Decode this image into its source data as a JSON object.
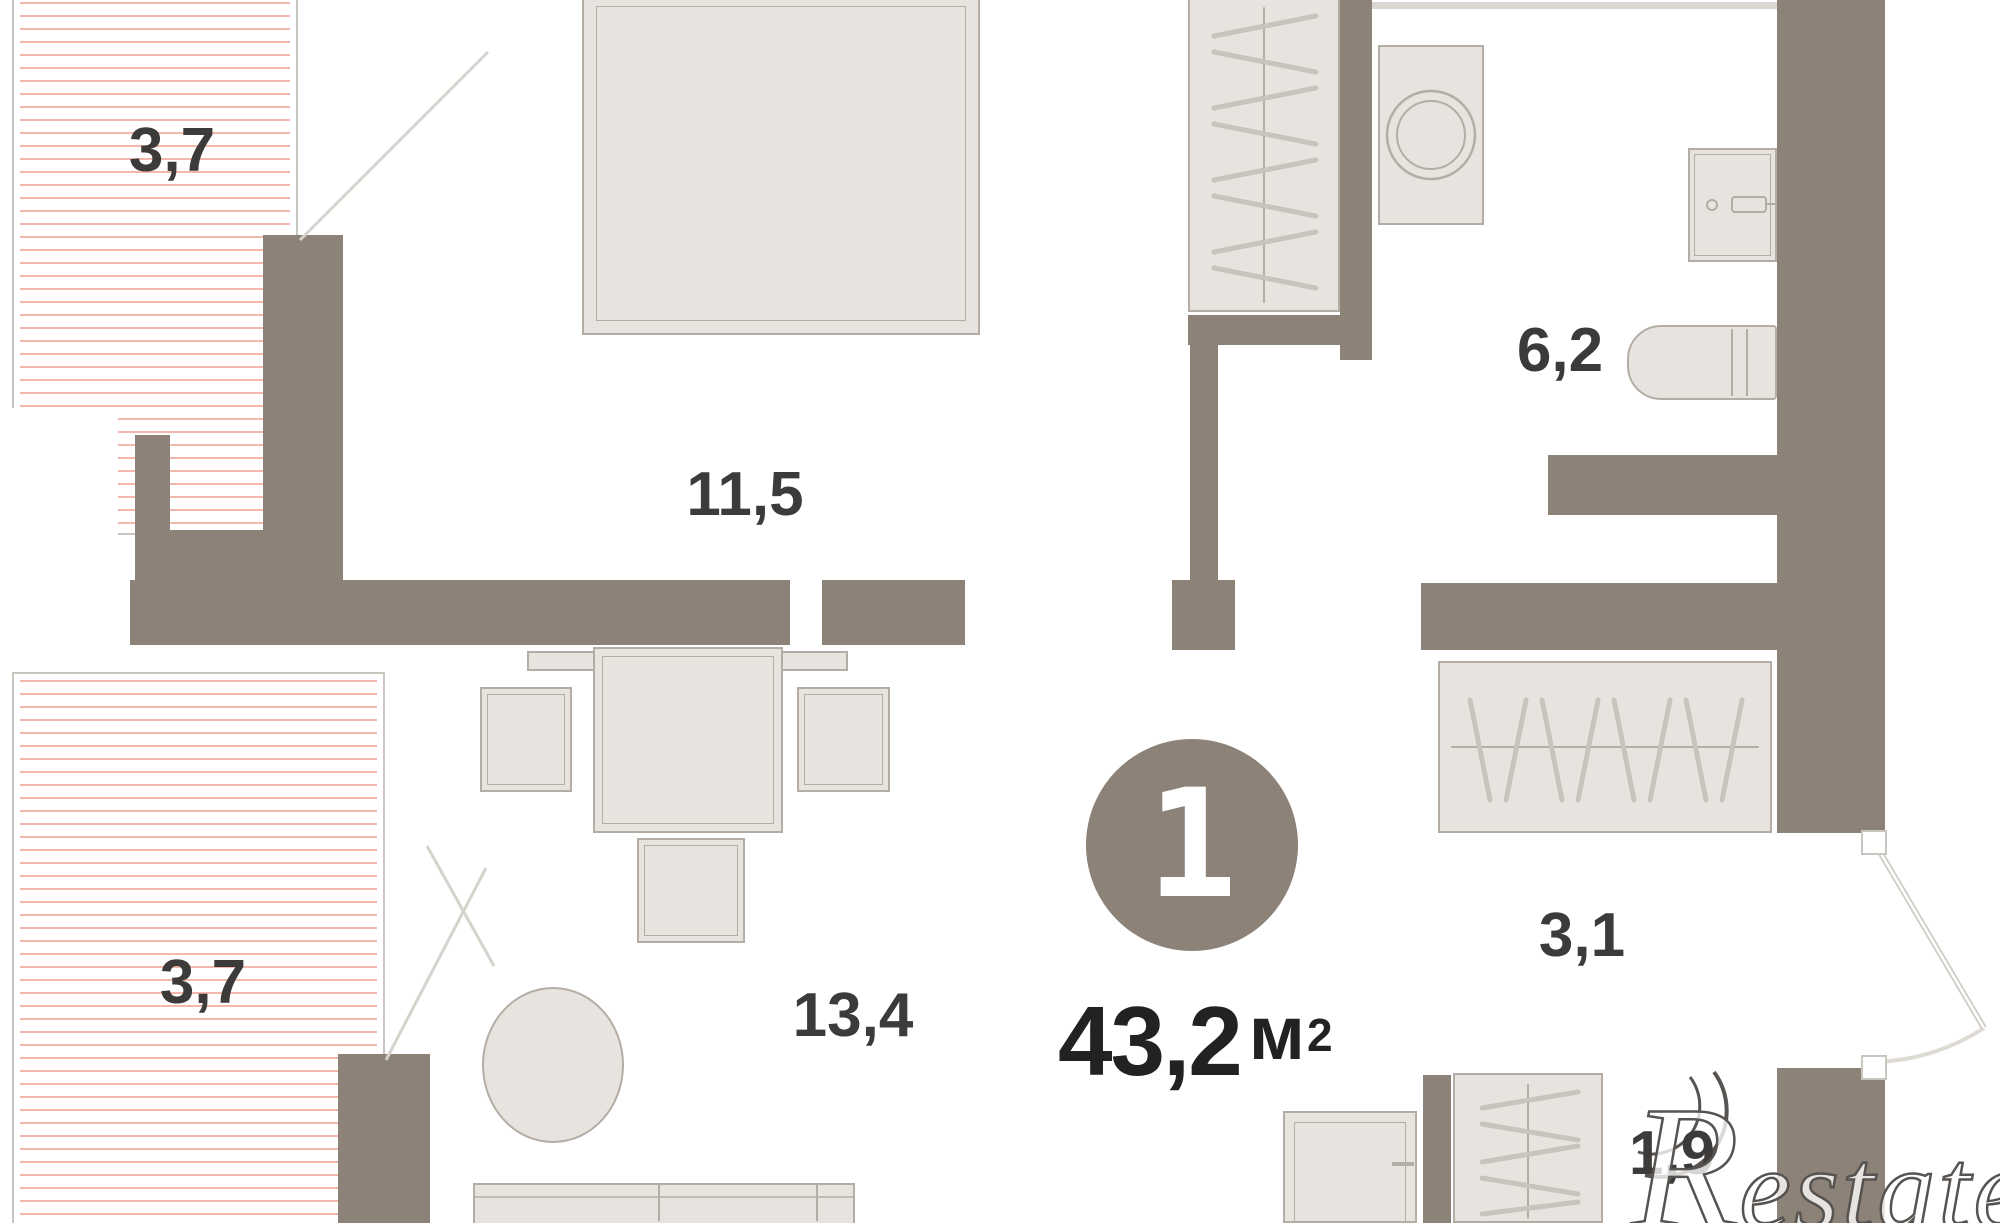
{
  "floor_plan": {
    "unit_badge": "1",
    "total_area": "43,2",
    "area_unit": "м",
    "area_exponent": "2",
    "labels": {
      "balcony_top": "3,7",
      "bedroom": "11,5",
      "bathroom": "6,2",
      "living_room": "13,4",
      "balcony_bottom": "3,7",
      "hallway": "3,1",
      "storage": "1,9"
    },
    "watermark": {
      "initial": "R",
      "rest": "estate"
    },
    "colors": {
      "wall": "#8c8277",
      "furniture_fill": "#e7e4df",
      "furniture_line": "#b3ada5",
      "balcony_hatch": "#f4b7ab",
      "label_text": "#3d3b39"
    }
  }
}
